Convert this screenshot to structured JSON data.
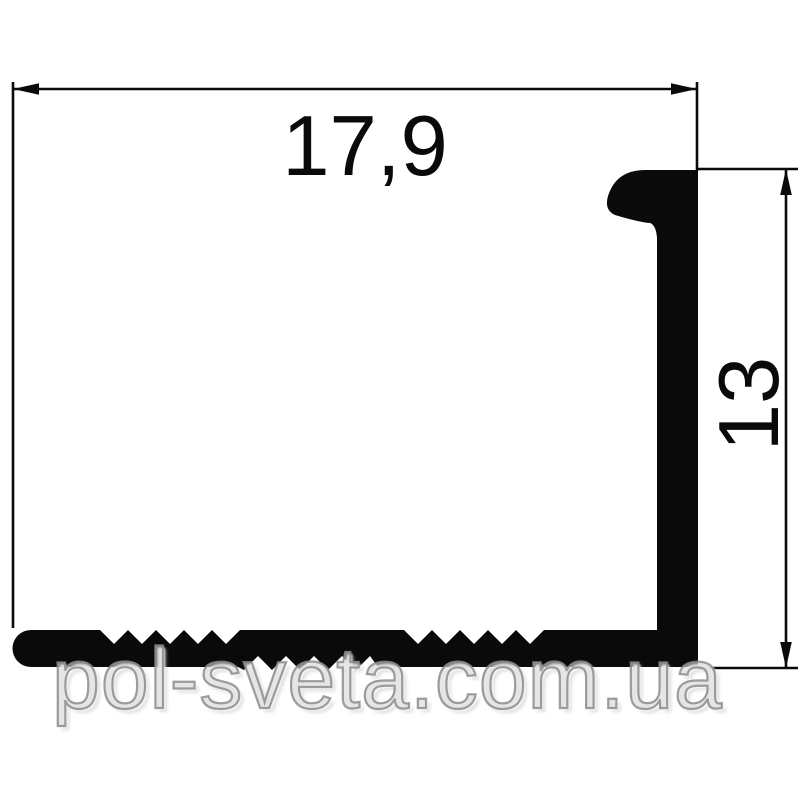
{
  "page": {
    "background_color": "#ffffff"
  },
  "drawing": {
    "kind": "aluminum-profile-cross-section",
    "line_color": "#0a0a0a",
    "profile_fill_color": "#0a0a0a",
    "dimensions": {
      "width": {
        "label": "17,9"
      },
      "height": {
        "label": "13"
      }
    }
  },
  "watermark": {
    "text": "pol-sveta.com.ua",
    "color": "#8c8c8c"
  }
}
